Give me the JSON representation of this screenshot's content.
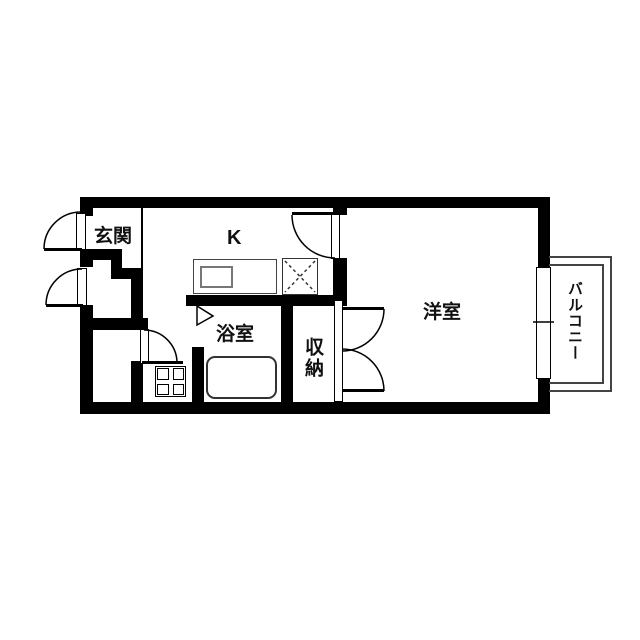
{
  "floorplan": {
    "rooms": {
      "genkan": {
        "label": "玄関"
      },
      "kitchen": {
        "label": "K"
      },
      "bathroom": {
        "label": "浴室"
      },
      "closet": {
        "label": "収納"
      },
      "western_room": {
        "label": "洋室"
      },
      "balcony": {
        "label": "バルコニー"
      }
    },
    "fixtures": {
      "entrance_door": "swing-door-icon",
      "meter_box_door": "swing-door-icon",
      "toilet_door": "swing-door-icon",
      "kitchen_room_door": "swing-door-icon",
      "closet_double_door": "double-swing-door-icon",
      "bath_folding_door": "folding-door-icon",
      "kitchen_counter": "counter-with-sink-icon",
      "appliance_space": "dashed-x-square-icon",
      "washing_machine_pan": "grid-square-icon",
      "bathtub": "bathtub-icon",
      "balcony_window": "sliding-window-icon"
    },
    "colors": {
      "wall": "#000000",
      "background": "#ffffff",
      "fixture_line": "#444444",
      "text": "#111111"
    }
  }
}
